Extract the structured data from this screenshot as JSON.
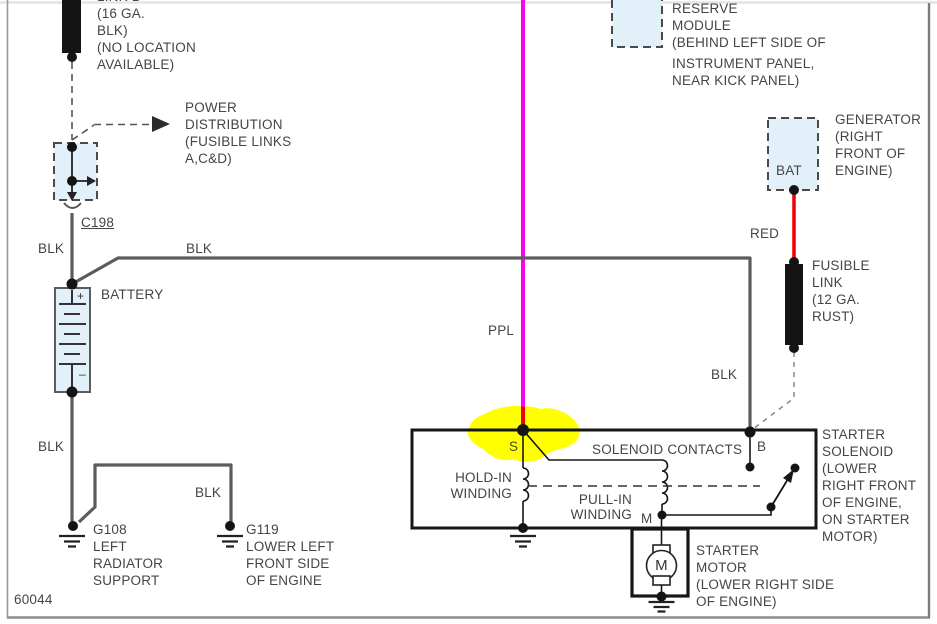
{
  "page": {
    "footer_code": "60044"
  },
  "colors": {
    "wire_gray": "#5c5c5c",
    "line_black": "#161616",
    "fill_blue": "#e2f0fa",
    "ppl": "#ff00f0",
    "red": "#ee0000",
    "highlight": "#ffff00",
    "text": "#454545"
  },
  "link_b": {
    "clipped": "LINK B",
    "lines": [
      "(16 GA.",
      "BLK)",
      "(NO LOCATION",
      "AVAILABLE)"
    ]
  },
  "power_distribution": {
    "lines": [
      "POWER",
      "DISTRIBUTION",
      "(FUSIBLE LINKS",
      "A,C&D)"
    ]
  },
  "connector": {
    "label": "C198"
  },
  "wire_labels": {
    "blk_left": "BLK",
    "blk_top": "BLK",
    "blk_battery": "BLK",
    "blk_g119": "BLK",
    "blk_right": "BLK",
    "ppl": "PPL",
    "red": "RED"
  },
  "battery": {
    "label": "BATTERY",
    "plus": "+",
    "minus": "–"
  },
  "grounds": {
    "g108": {
      "lines": [
        "G108",
        "LEFT",
        "RADIATOR",
        "SUPPORT"
      ]
    },
    "g119": {
      "lines": [
        "G119",
        "LOWER LEFT",
        "FRONT SIDE",
        "OF ENGINE"
      ]
    }
  },
  "reserve_module": {
    "lines": [
      "RESERVE",
      "MODULE",
      "(BEHIND LEFT SIDE OF",
      "INSTRUMENT PANEL,",
      "NEAR KICK PANEL)"
    ]
  },
  "generator": {
    "terminal": "BAT",
    "lines": [
      "GENERATOR",
      "(RIGHT",
      "FRONT OF",
      "ENGINE)"
    ]
  },
  "fusible_link": {
    "lines": [
      "FUSIBLE",
      "LINK",
      "(12 GA.",
      "RUST)"
    ]
  },
  "solenoid": {
    "terminal_s": "S",
    "terminal_b": "B",
    "terminal_m": "M",
    "contacts_label": "SOLENOID CONTACTS",
    "hold_in": [
      "HOLD-IN",
      "WINDING"
    ],
    "pull_in": [
      "PULL-IN",
      "WINDING"
    ],
    "lines": [
      "STARTER",
      "SOLENOID",
      "(LOWER",
      "RIGHT FRONT",
      "OF ENGINE,",
      "ON STARTER",
      "MOTOR)"
    ]
  },
  "starter_motor": {
    "symbol": "M",
    "lines": [
      "STARTER",
      "MOTOR",
      "(LOWER RIGHT SIDE",
      "OF ENGINE)"
    ]
  }
}
